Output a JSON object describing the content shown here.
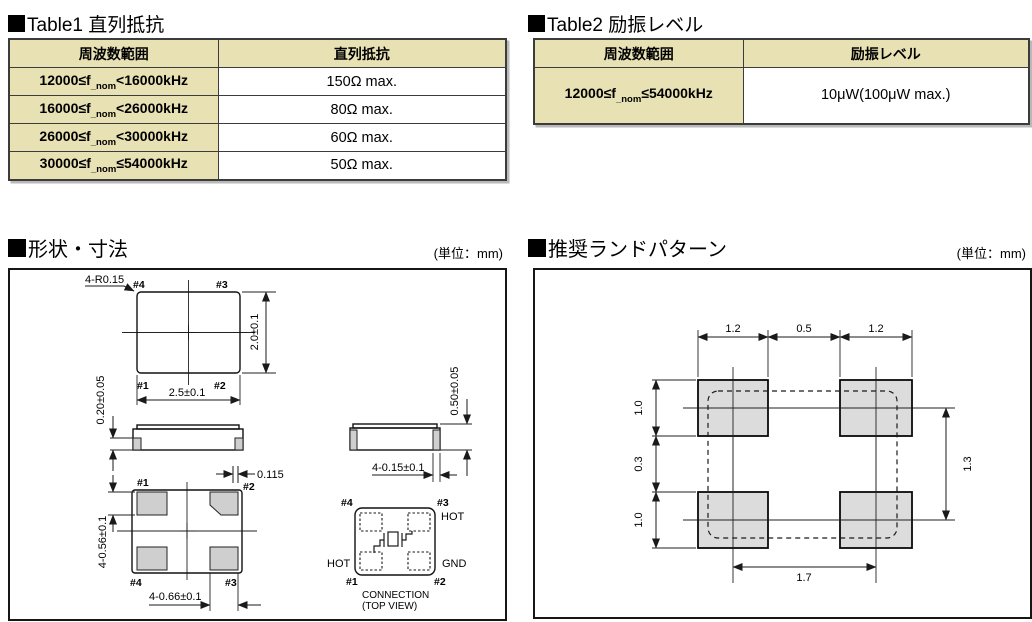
{
  "colors": {
    "header_bg": "#e8e1b4",
    "pad_gray": "#dcdcdc",
    "border_dark": "#3c3c3c"
  },
  "table1": {
    "title": "Table1 直列抵抗",
    "col_headers": [
      "周波数範囲",
      "直列抵抗"
    ],
    "rows": [
      {
        "f_pre": "12000≤f",
        "f_sub": "_nom",
        "f_post": "<16000kHz",
        "value": "150Ω max."
      },
      {
        "f_pre": "16000≤f",
        "f_sub": "_nom",
        "f_post": "<26000kHz",
        "value": "80Ω max."
      },
      {
        "f_pre": "26000≤f",
        "f_sub": "_nom",
        "f_post": "<30000kHz",
        "value": "60Ω max."
      },
      {
        "f_pre": "30000≤f",
        "f_sub": "_nom",
        "f_post": "≤54000kHz",
        "value": "50Ω max."
      }
    ]
  },
  "table2": {
    "title": "Table2 励振レベル",
    "col_headers": [
      "周波数範囲",
      "励振レベル"
    ],
    "rows": [
      {
        "f_pre": "12000≤f",
        "f_sub": "_nom",
        "f_post": "≤54000kHz",
        "value": "10μW(100μW max.)"
      }
    ]
  },
  "shape": {
    "title": "形状・寸法",
    "unit": "(単位：mm)",
    "top_view": {
      "radius_note": "4-R0.15",
      "pin_tl": "#4",
      "pin_tr": "#3",
      "pin_bl": "#1",
      "pin_br": "#2",
      "dim_width": "2.5±0.1",
      "dim_height": "2.0±0.1"
    },
    "side_left": {
      "dim_pad_thickness": "0.20±0.05"
    },
    "side_right": {
      "dim_height": "0.50±0.05",
      "dim_pad": "4-0.15±0.1"
    },
    "bottom_view": {
      "pin_tl": "#1",
      "pin_tr": "#2",
      "pin_bl": "#4",
      "pin_br": "#3",
      "dim_offset": "0.115",
      "dim_pad_h": "4-0.56±0.1",
      "dim_pad_w": "4-0.66±0.1"
    },
    "connection": {
      "pin_tl": "#4",
      "pin_tr": "#3",
      "pin_bl": "#1",
      "pin_br": "#2",
      "label_tr": "HOT",
      "label_bl": "HOT",
      "label_br": "GND",
      "caption1": "CONNECTION",
      "caption2": "(TOP VIEW)"
    }
  },
  "land": {
    "title": "推奨ランドパターン",
    "unit": "(単位：mm)",
    "dim_pad_w_left": "1.2",
    "dim_gap": "0.5",
    "dim_pad_w_right": "1.2",
    "dim_pad_h_top": "1.0",
    "dim_row_gap": "0.3",
    "dim_pad_h_bottom": "1.0",
    "dim_v_pitch": "1.3",
    "dim_h_pitch": "1.7"
  }
}
